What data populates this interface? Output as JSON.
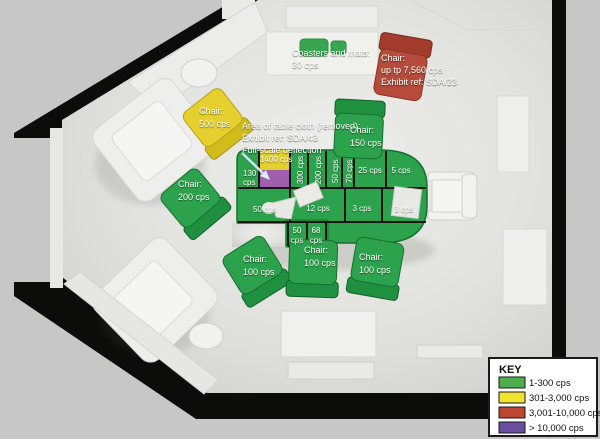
{
  "legend": {
    "title": "KEY",
    "entries": [
      {
        "label": "1-300 cps",
        "color": "#4fae4e"
      },
      {
        "label": "301-3,000 cps",
        "color": "#f0e32f"
      },
      {
        "label": "3,001-10,000 cps",
        "color": "#bd4733"
      },
      {
        "label": "> 10,000 cps",
        "color": "#6a4fa0"
      }
    ]
  },
  "annotations": {
    "coasters": {
      "lines": [
        "Coasters and mats:",
        "30 cps"
      ]
    },
    "red_chair": {
      "lines": [
        "Chair:",
        "up tp 7,560 cps",
        "Exhibit ref: SDA/23"
      ]
    },
    "yellow_chair": {
      "lines": [
        "Chair:",
        "500 cps"
      ]
    },
    "tablecloth": {
      "lines": [
        "Area of table cloth (removed):",
        "Exhibit ref: SDA/43",
        "Full-scale deflection"
      ]
    },
    "left_chair": {
      "lines": [
        "Chair:",
        "200 cps"
      ]
    },
    "top_chair": {
      "lines": [
        "Chair:",
        "150 cps"
      ]
    },
    "bottom_left_chair": {
      "lines": [
        "Chair:",
        "100 cps"
      ]
    },
    "bottom_center_chair": {
      "lines": [
        "Chair:",
        "100 cps"
      ]
    },
    "bottom_right_chair": {
      "lines": [
        "Chair:",
        "100 cps"
      ]
    }
  },
  "table": {
    "cells": {
      "tablecloth_area": {
        "value": "1400 cps"
      },
      "c130": {
        "num": "130",
        "unit": "cps"
      },
      "c300": {
        "value": "300 cps"
      },
      "c200": {
        "value": "200 cps"
      },
      "c50_vert": {
        "value": "50 cps"
      },
      "c70": {
        "value": "70 cps"
      },
      "c25": {
        "value": "25 cps"
      },
      "c5": {
        "value": "5 cps"
      },
      "c50_large": {
        "value": "50 cps"
      },
      "c12": {
        "value": "12 cps"
      },
      "c3_left": {
        "value": "3 cps"
      },
      "c3_right": {
        "value": "3 cps"
      },
      "c50_small": {
        "num": "50",
        "unit": "cps"
      },
      "c68": {
        "num": "68",
        "unit": "cps"
      }
    }
  }
}
